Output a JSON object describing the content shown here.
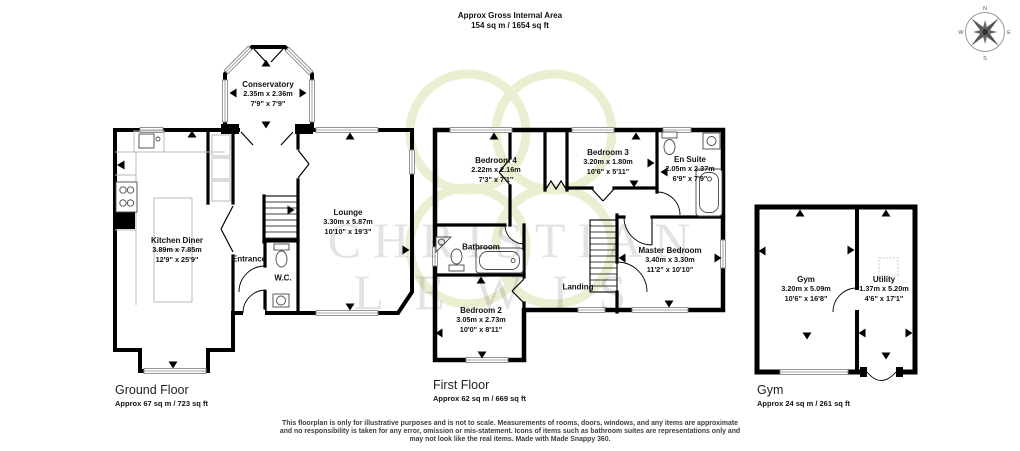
{
  "header": {
    "title": "Approx Gross Internal Area",
    "area": "154 sq m / 1654 sq ft"
  },
  "watermark": {
    "line1": "CHRISTIAN",
    "line2": "LEWIS"
  },
  "compass": {
    "n": "N",
    "e": "E",
    "s": "S",
    "w": "W"
  },
  "colors": {
    "wall": "#000000",
    "window_frame": "#8a8a8a",
    "watermark_text": "#e2e2e2",
    "emblem": "#e9ecc9"
  },
  "floors": [
    {
      "name": "Ground Floor",
      "area": "Approx 67 sq m / 723 sq ft",
      "rooms": [
        {
          "name": "Conservatory",
          "m": "2.35m x 2.36m",
          "ft": "7'9\" x 7'9\""
        },
        {
          "name": "Kitchen Diner",
          "m": "3.89m x 7.85m",
          "ft": "12'9\" x 25'9\""
        },
        {
          "name": "Lounge",
          "m": "3.30m x 5.87m",
          "ft": "10'10\" x 19'3\""
        },
        {
          "name": "Entrance"
        },
        {
          "name": "W.C."
        }
      ]
    },
    {
      "name": "First Floor",
      "area": "Approx 62 sq m / 669 sq ft",
      "rooms": [
        {
          "name": "Bedroom 4",
          "m": "2.22m x 2.16m",
          "ft": "7'3\" x 7'1\""
        },
        {
          "name": "Bedroom 3",
          "m": "3.20m x 1.80m",
          "ft": "10'6\" x 5'11\""
        },
        {
          "name": "En Suite",
          "m": "2.05m x 2.37m",
          "ft": "6'9\" x 7'9\""
        },
        {
          "name": "Bathroom"
        },
        {
          "name": "Master Bedroom",
          "m": "3.40m x 3.30m",
          "ft": "11'2\" x 10'10\""
        },
        {
          "name": "Landing"
        },
        {
          "name": "Bedroom 2",
          "m": "3.05m x 2.73m",
          "ft": "10'0\" x 8'11\""
        }
      ]
    },
    {
      "name": "Gym",
      "area": "Approx 24 sq m / 261 sq ft",
      "rooms": [
        {
          "name": "Gym",
          "m": "3.20m x 5.09m",
          "ft": "10'6\" x 16'8\""
        },
        {
          "name": "Utility",
          "m": "1.37m x 5.20m",
          "ft": "4'6\" x 17'1\""
        }
      ]
    }
  ],
  "footer": {
    "line1": "This floorplan is only for illustrative purposes and is not to scale. Measurements of rooms, doors, windows, and any items are approximate",
    "line2": "and no responsibility is taken for any error, omission or mis-statement. Icons of items such as bathroom suites are representations only and",
    "line3": "may not look like the real items. Made with Made Snappy 360."
  }
}
